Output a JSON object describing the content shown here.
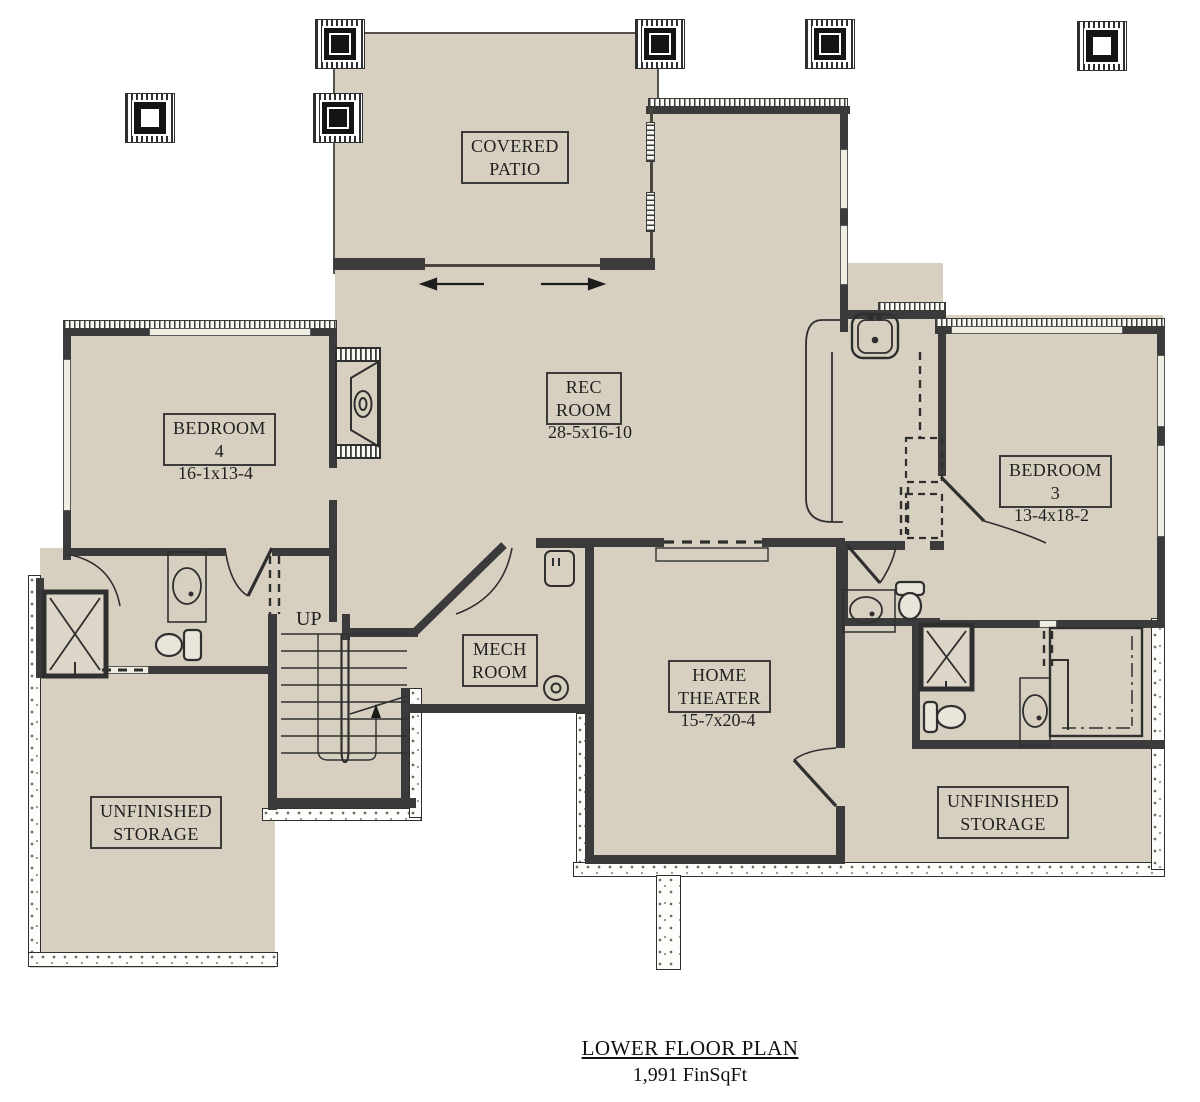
{
  "colors": {
    "floor": "#d7d0c1",
    "wall": "#3b3b3b",
    "paper": "#ffffff"
  },
  "rooms": {
    "covered_patio": {
      "line1": "COVERED",
      "line2": "PATIO"
    },
    "rec_room": {
      "line1": "REC",
      "line2": "ROOM",
      "dims": "28-5x16-10"
    },
    "bedroom4": {
      "line1": "BEDROOM",
      "line2": "4",
      "dims": "16-1x13-4"
    },
    "bedroom3": {
      "line1": "BEDROOM",
      "line2": "3",
      "dims": "13-4x18-2"
    },
    "mech_room": {
      "line1": "MECH",
      "line2": "ROOM"
    },
    "home_theater": {
      "line1": "HOME",
      "line2": "THEATER",
      "dims": "15-7x20-4"
    },
    "unfinished_storage_left": {
      "line1": "UNFINISHED",
      "line2": "STORAGE"
    },
    "unfinished_storage_right": {
      "line1": "UNFINISHED",
      "line2": "STORAGE"
    }
  },
  "stairs": {
    "direction_label": "UP"
  },
  "footer": {
    "title": "LOWER FLOOR PLAN",
    "area": "1,991 FinSqFt"
  }
}
